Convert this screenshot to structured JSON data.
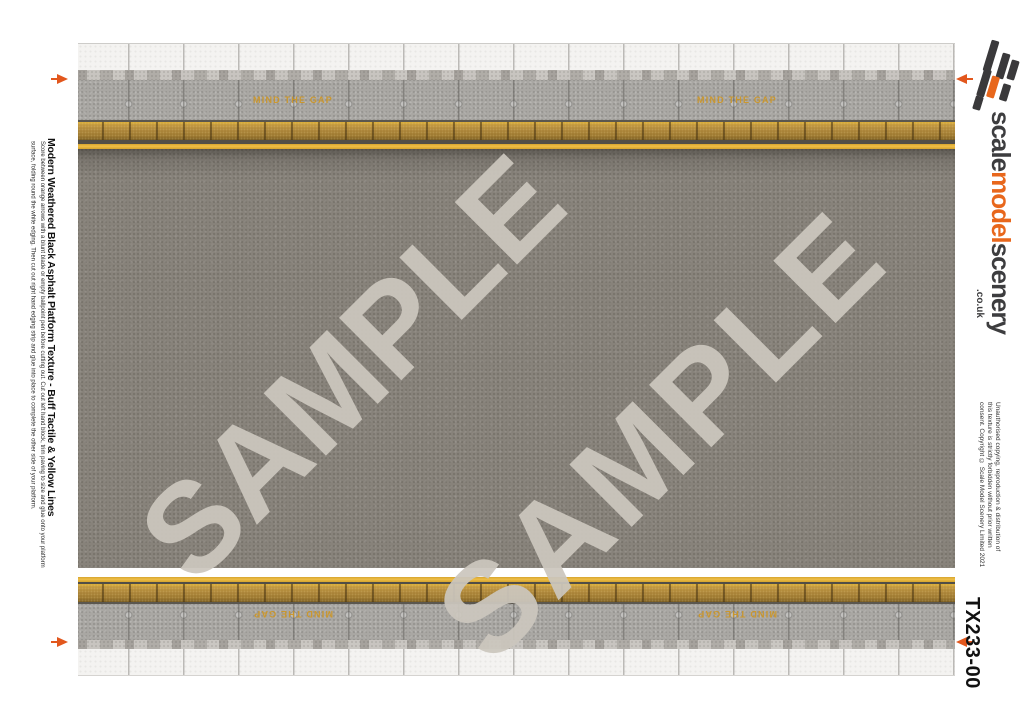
{
  "left_panel": {
    "title": "Modern Weathered Black Asphalt Platform Texture - Buff Tactile & Yellow Lines",
    "instructions": "Score between orange arrows with a blunt blade or empty ballpoint pen before cutting out. Cut out left hand block, trim paving to size and glue onto your platform surface, folding round the white edging. Then cut out right hand edging strip and glue into place to complete the other side of your platform."
  },
  "texture": {
    "mind_the_gap": "MIND THE GAP",
    "watermark": "SAMPLE"
  },
  "brand": {
    "name_part1": "scale",
    "name_part2": "model",
    "name_part3": "scenery",
    "domain": ".co.uk"
  },
  "right_panel": {
    "copyright_line1": "Unauthorised copying, reproduction & distribution of",
    "copyright_line2": "this texture is strictly forbidden without prior written",
    "copyright_line3": "consent. Copyright © Scale Model Scenery Limited 2021",
    "product_code": "TX233-00"
  },
  "colors": {
    "accent_orange": "#e2571d",
    "brand_orange": "#e8671c",
    "brand_dark": "#3a393b",
    "yellow_line": "#eebd46",
    "tactile_buff": "#ac8539",
    "asphalt_grey": "#87827a",
    "concrete_grey": "#a9a7a3",
    "mind_the_gap_text": "#cf951f",
    "watermark_grey": "#ccc7be"
  }
}
